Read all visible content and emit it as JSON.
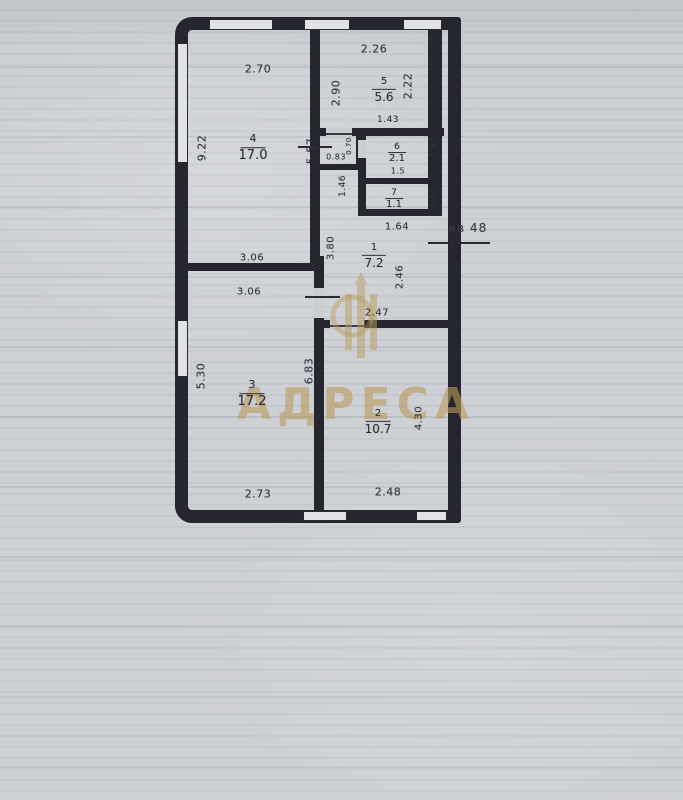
{
  "watermark": {
    "text": "АДРЕСА"
  },
  "note": {
    "apartment_label": "кв 48"
  },
  "rooms": [
    {
      "number": "4",
      "area": "17.0"
    },
    {
      "number": "5",
      "area": "5.6"
    },
    {
      "number": "6",
      "area": "2.1"
    },
    {
      "number": "7",
      "area": "1.1"
    },
    {
      "number": "1",
      "area": "7.2"
    },
    {
      "number": "2",
      "area": "10.7"
    },
    {
      "number": "3",
      "area": "17.2"
    }
  ],
  "dimensions": [
    {
      "text": "2.70"
    },
    {
      "text": "9.22"
    },
    {
      "text": "2.26"
    },
    {
      "text": "2.90"
    },
    {
      "text": "2.22"
    },
    {
      "text": "5.57"
    },
    {
      "text": "1.43"
    },
    {
      "text": "0.70"
    },
    {
      "text": "0.83"
    },
    {
      "text": "1.46"
    },
    {
      "text": "1.37"
    },
    {
      "text": "0.93"
    },
    {
      "text": "1.64"
    },
    {
      "text": "3.80"
    },
    {
      "text": "2.46"
    },
    {
      "text": "2.47"
    },
    {
      "text": "3.06"
    },
    {
      "text": "3.06"
    },
    {
      "text": "5.30"
    },
    {
      "text": "6.83"
    },
    {
      "text": "4.30"
    },
    {
      "text": "2.73"
    },
    {
      "text": "2.48"
    },
    {
      "text": "1.5"
    }
  ]
}
